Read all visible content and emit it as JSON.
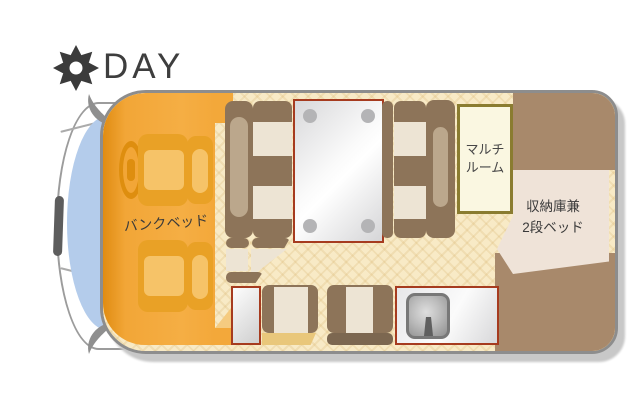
{
  "header": {
    "title": "DAY",
    "icon": "sun"
  },
  "labels": {
    "bunk_bed": "バンクベッド",
    "multi_room_line1": "マルチ",
    "multi_room_line2": "ルーム",
    "storage_line1": "収納庫兼",
    "storage_line2": "2段ベッド"
  },
  "palette": {
    "cab_orange": "#f3a83a",
    "seat_orange": "#e9a126",
    "bench_brown": "#8d7459",
    "cushion_cream": "#ede4d4",
    "rear_brown": "#a8896b",
    "floor_cream": "#f8eac6",
    "multiroom_border": "#8a7c30",
    "fixture_border": "#a63b1f",
    "windshield_blue": "#b4cceb",
    "body_border": "#8d8d8d",
    "text": "#3c3c3c"
  }
}
